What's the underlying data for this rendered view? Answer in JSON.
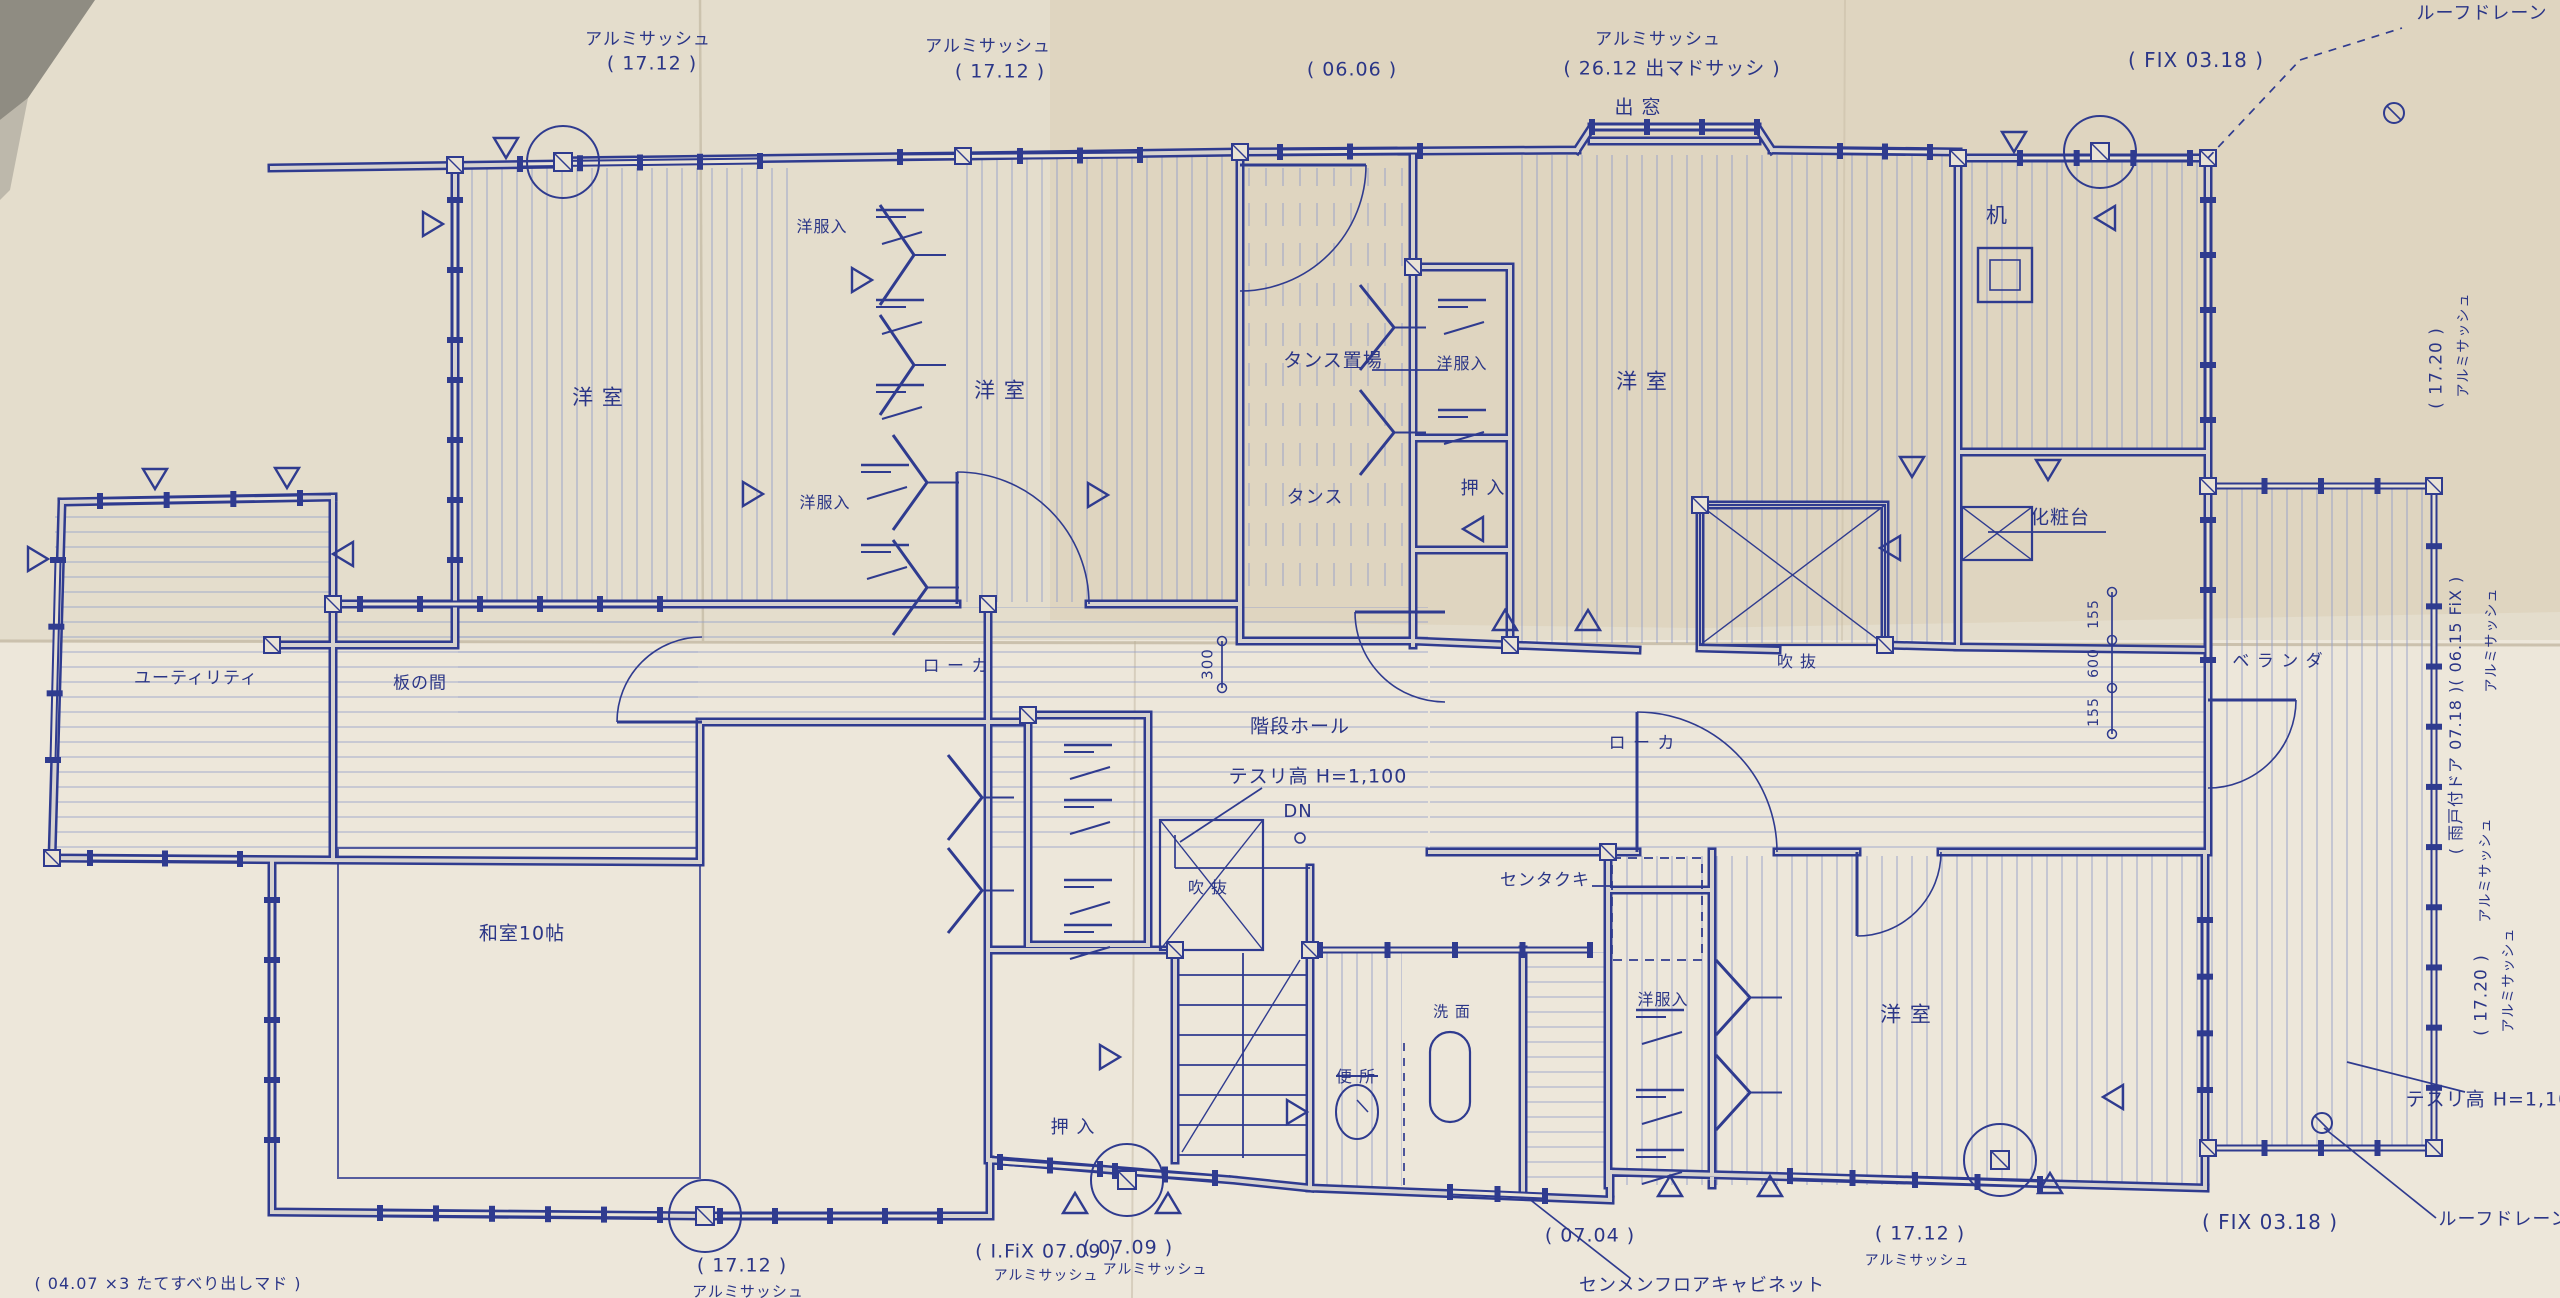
{
  "document": {
    "kind": "scanned architectural floor plan (Japanese residence, upper floor)",
    "language": "Japanese"
  },
  "colors": {
    "ink": "#2f3b8f",
    "ink_light": "#939ec9",
    "paper": "#e9e3d6",
    "paper_shade": "#d6cab4",
    "crease": "#bdb29b",
    "photo_edge": "#8f8c82"
  },
  "labels": [
    {
      "name": "window-label-alum-t1",
      "text": "アルミサッシュ"
    },
    {
      "name": "window-size-17-12-a",
      "text": "( 17.12 )"
    },
    {
      "name": "window-label-alum-t2",
      "text": "アルミサッシュ"
    },
    {
      "name": "window-size-17-12-b",
      "text": "( 17.12 )"
    },
    {
      "name": "window-size-06-06",
      "text": "( 06.06 )"
    },
    {
      "name": "window-label-alum-bay",
      "text": "アルミサッシュ"
    },
    {
      "name": "window-size-26-12-bay",
      "text": "( 26.12 出マドサッシ )"
    },
    {
      "name": "room-demado",
      "text": "出 窓"
    },
    {
      "name": "window-size-fix-03-18-top",
      "text": "( FIX 03.18 )"
    },
    {
      "name": "roof-drain-top",
      "text": "ルーフドレーン"
    },
    {
      "name": "window-size-17-20-a",
      "text": "( 17.20 )"
    },
    {
      "name": "window-label-alum-r1",
      "text": "アルミサッシュ"
    },
    {
      "name": "window-size-amado-fix",
      "text": "( 雨戸付ドア 07.18 )( 06.15 FiX )"
    },
    {
      "name": "window-label-alum-r2",
      "text": "アルミサッシュ"
    },
    {
      "name": "window-label-alum-r3",
      "text": "アルミサッシュ"
    },
    {
      "name": "window-size-17-20-b",
      "text": "( 17.20 )"
    },
    {
      "name": "window-label-alum-r4",
      "text": "アルミサッシュ"
    },
    {
      "name": "handrail-note-right",
      "text": "テスリ高 H=1,100"
    },
    {
      "name": "roof-drain-bottom",
      "text": "ルーフドレーン"
    },
    {
      "name": "window-size-fix-03-18-bottom",
      "text": "( FIX 03.18 )"
    },
    {
      "name": "window-size-04-07",
      "text": "( 04.07 ×3  たてすべり出しマド )"
    },
    {
      "name": "window-size-17-12-c",
      "text": "( 17.12 )"
    },
    {
      "name": "window-label-alum-b1",
      "text": "アルミサッシュ"
    },
    {
      "name": "window-size-fix-07-09",
      "text": "( I.FiX 07.09 )"
    },
    {
      "name": "window-label-alum-b2",
      "text": "アルミサッシュ"
    },
    {
      "name": "window-size-07-09",
      "text": "( 07.09 )"
    },
    {
      "name": "window-label-alum-b3",
      "text": "アルミサッシュ"
    },
    {
      "name": "window-size-07-04",
      "text": "( 07.04 )"
    },
    {
      "name": "fixture-senmen-cabinet",
      "text": "センメンフロアキャビネット"
    },
    {
      "name": "window-size-17-12-d",
      "text": "( 17.12 )"
    },
    {
      "name": "window-label-alum-b4",
      "text": "アルミサッシュ"
    },
    {
      "name": "room-yoshitsu-left",
      "text": "洋  室"
    },
    {
      "name": "closet-yofukuire-1",
      "text": "洋服入"
    },
    {
      "name": "closet-yofukuire-2",
      "text": "洋服入"
    },
    {
      "name": "room-yoshitsu-mid",
      "text": "洋  室"
    },
    {
      "name": "area-tansu-okiba",
      "text": "タンス置場"
    },
    {
      "name": "closet-yofukuire-3",
      "text": "洋服入"
    },
    {
      "name": "room-yoshitsu-right",
      "text": "洋  室"
    },
    {
      "name": "area-tansu",
      "text": "タンス"
    },
    {
      "name": "closet-oshiire-top",
      "text": "押 入"
    },
    {
      "name": "fixture-tsukue",
      "text": "机"
    },
    {
      "name": "fixture-keshodai",
      "text": "化粧台"
    },
    {
      "name": "room-veranda",
      "text": "ベ ラ ン ダ"
    },
    {
      "name": "room-utility",
      "text": "ユーティリティ"
    },
    {
      "name": "room-itanoma",
      "text": "板の間"
    },
    {
      "name": "room-washitsu-10",
      "text": "和室10帖"
    },
    {
      "name": "room-roka-left",
      "text": "ロ ー カ"
    },
    {
      "name": "room-kaidan-hall",
      "text": "階段ホール"
    },
    {
      "name": "handrail-note-center",
      "text": "テスリ高 H=1,100"
    },
    {
      "name": "stair-dn",
      "text": "DN"
    },
    {
      "name": "void-fukinuke-left",
      "text": "吹 抜"
    },
    {
      "name": "void-fukinuke-right",
      "text": "吹 抜"
    },
    {
      "name": "room-roka-right",
      "text": "ロ ー カ"
    },
    {
      "name": "fixture-sentakuki",
      "text": "センタクキ"
    },
    {
      "name": "room-benjo",
      "text": "便 所"
    },
    {
      "name": "room-senmen",
      "text": "洗 面"
    },
    {
      "name": "closet-oshiire-bottom",
      "text": "押 入"
    },
    {
      "name": "closet-yofukuire-4",
      "text": "洋服入"
    },
    {
      "name": "room-yoshitsu-br",
      "text": "洋  室"
    },
    {
      "name": "dim-300",
      "text": "300"
    },
    {
      "name": "dim-155-a",
      "text": "155"
    },
    {
      "name": "dim-600",
      "text": "600"
    },
    {
      "name": "dim-155-b",
      "text": "155"
    }
  ]
}
